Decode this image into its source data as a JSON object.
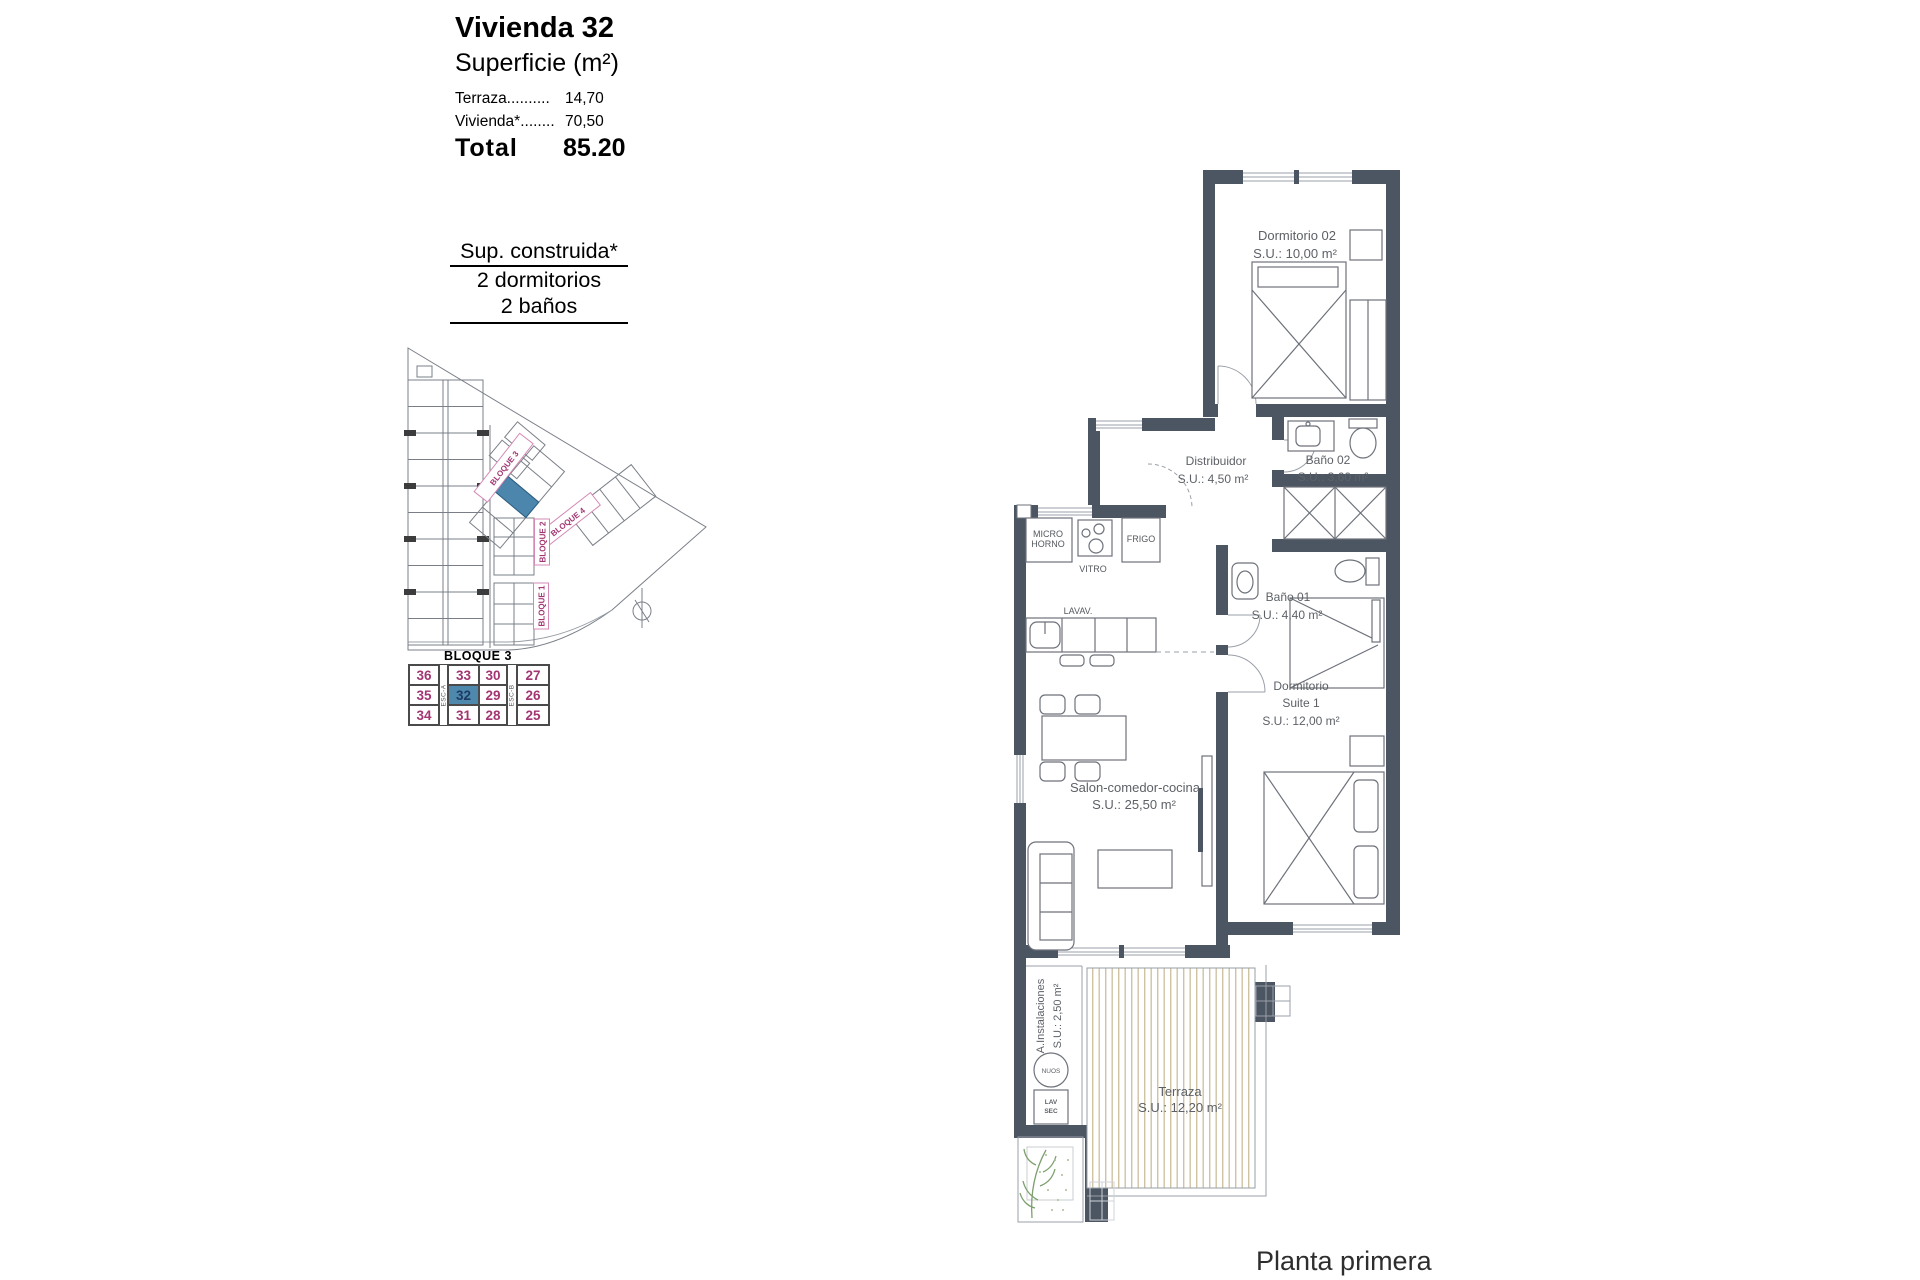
{
  "info": {
    "title": "Vivienda 32",
    "subtitle": "Superficie (m²)",
    "terraza_label": "Terraza..........",
    "terraza_value": "14,70",
    "vivienda_label": "Vivienda*........",
    "vivienda_value": "70,50",
    "total_label": "Total",
    "total_value": "85.20"
  },
  "summary": {
    "construida": "Sup. construida*",
    "dormitorios": "2 dormitorios",
    "banos": "2 baños"
  },
  "site": {
    "bloque1": "BLOQUE 1",
    "bloque2": "BLOQUE 2",
    "bloque3": "BLOQUE 3",
    "bloque4": "BLOQUE 4"
  },
  "block_table": {
    "title": "BLOQUE 3",
    "esc_a": "ESC-A",
    "esc_b": "ESC-B",
    "rows": [
      [
        "36",
        "33",
        "30",
        "27"
      ],
      [
        "35",
        "32",
        "29",
        "26"
      ],
      [
        "34",
        "31",
        "28",
        "25"
      ]
    ],
    "highlighted_unit": "32"
  },
  "rooms": {
    "dorm02": {
      "name": "Dormitorio 02",
      "area": "S.U.: 10,00 m²"
    },
    "bano02": {
      "name": "Baño 02",
      "area": "S.U.: 3,60 m²"
    },
    "distribuidor": {
      "name": "Distribuidor",
      "area": "S.U.: 4,50 m²"
    },
    "bano01": {
      "name": "Baño 01",
      "area": "S.U.: 4,40 m²"
    },
    "suite": {
      "name1": "Dormitorio",
      "name2": "Suite 1",
      "area": "S.U.: 12,00 m²"
    },
    "salon": {
      "name": "Salon-comedor-cocina",
      "area": "S.U.: 25,50 m²"
    },
    "terraza": {
      "name": "Terraza",
      "area": "S.U.: 12,20 m²"
    },
    "instalaciones": {
      "name": "A.Instalaciones",
      "area": "S.U.: 2,50 m²"
    }
  },
  "kitchen": {
    "micro": [
      "MICRO",
      "HORNO"
    ],
    "vitro": "VITRO",
    "frigo": "FRIGO",
    "lavav": "LAVAV."
  },
  "utility": {
    "nuos": "NUOS",
    "lav": "LAV",
    "sec": "SEC"
  },
  "footer": {
    "caption": "Planta primera"
  },
  "colors": {
    "wall": "#4c5562",
    "unit_highlight": "#4d86ad",
    "label_magenta": "#a23572",
    "deck_stripe": "#cfc3a4",
    "plant_green": "#7da06e"
  }
}
